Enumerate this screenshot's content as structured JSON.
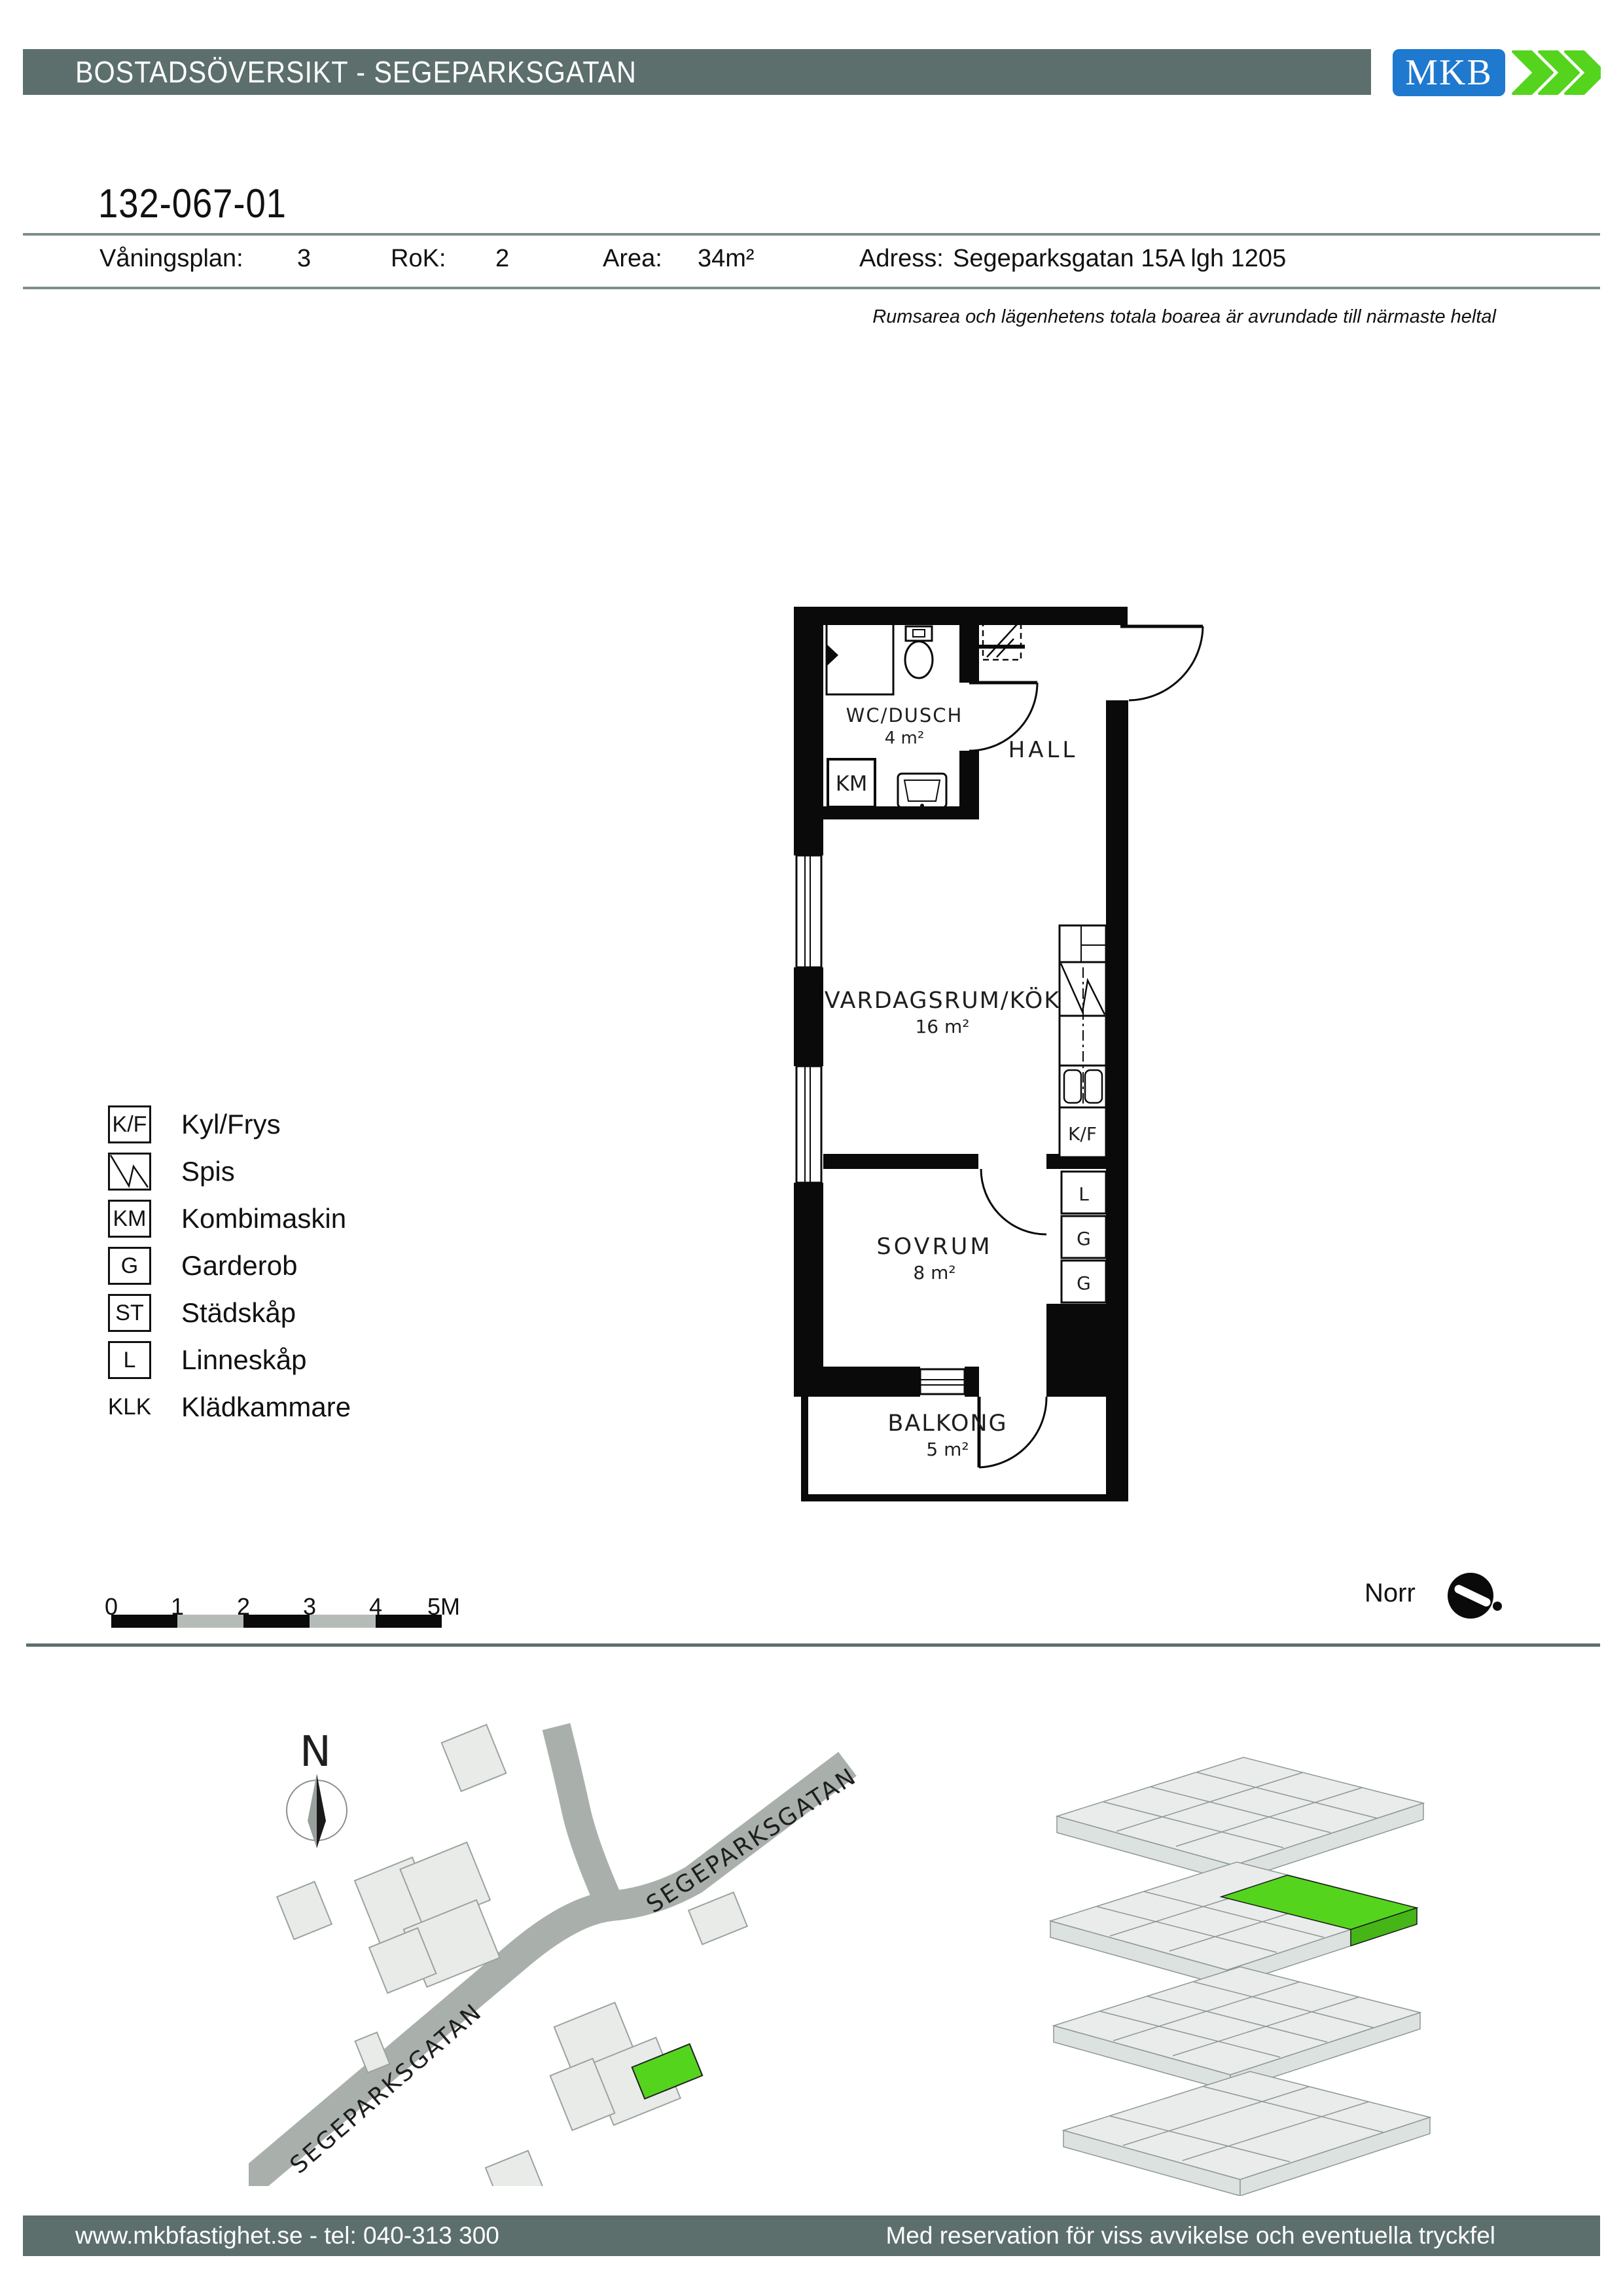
{
  "colors": {
    "slate_bar": "#5c6f6d",
    "logo_blue": "#1e79cf",
    "brand_green": "#55d41e",
    "scalebar_gray": "#b5bcb8",
    "road_gray": "#a9b0ac",
    "building_gray": "#e9ebe9"
  },
  "header": {
    "title": "BOSTADSÖVERSIKT - SEGEPARKSGATAN",
    "logo_text": "MKB"
  },
  "apartment": {
    "id": "132-067-01",
    "info": [
      {
        "label": "Våningsplan:",
        "value": "3"
      },
      {
        "label": "RoK:",
        "value": "2"
      },
      {
        "label": "Area:",
        "value": "34m²"
      },
      {
        "label": "Adress:",
        "value": "Segeparksgatan 15A lgh 1205"
      }
    ],
    "note": "Rumsarea och lägenhetens totala boarea är avrundade till närmaste heltal"
  },
  "plan": {
    "wc": {
      "name": "WC/DUSCH",
      "area": "4 m²"
    },
    "hall": {
      "name": "HALL"
    },
    "living": {
      "name": "VARDAGSRUM/KÖK",
      "area": "16 m²"
    },
    "bedroom": {
      "name": "SOVRUM",
      "area": "8 m²"
    },
    "balcony": {
      "name": "BALKONG",
      "area": "5 m²"
    },
    "km": "KM",
    "kf": "K/F",
    "closets": [
      "L",
      "G",
      "G"
    ]
  },
  "legend": {
    "items": [
      {
        "symbol": "K/F",
        "label": "Kyl/Frys"
      },
      {
        "symbol": "spis-icon",
        "label": "Spis"
      },
      {
        "symbol": "KM",
        "label": "Kombimaskin"
      },
      {
        "symbol": "G",
        "label": "Garderob"
      },
      {
        "symbol": "ST",
        "label": "Städskåp"
      },
      {
        "symbol": "L",
        "label": "Linneskåp"
      },
      {
        "symbol": "KLK",
        "label": "Klädkammare"
      }
    ]
  },
  "scalebar": {
    "labels": [
      "0",
      "1",
      "2",
      "3",
      "4",
      "5M"
    ]
  },
  "compass": {
    "label": "Norr"
  },
  "sitemap": {
    "north": "N",
    "street_upper": "SEGEPARKSGATAN",
    "street_lower": "SEGEPARKSGATAN"
  },
  "footer": {
    "left": "www.mkbfastighet.se - tel: 040-313 300",
    "right": "Med reservation för viss avvikelse och eventuella tryckfel"
  }
}
